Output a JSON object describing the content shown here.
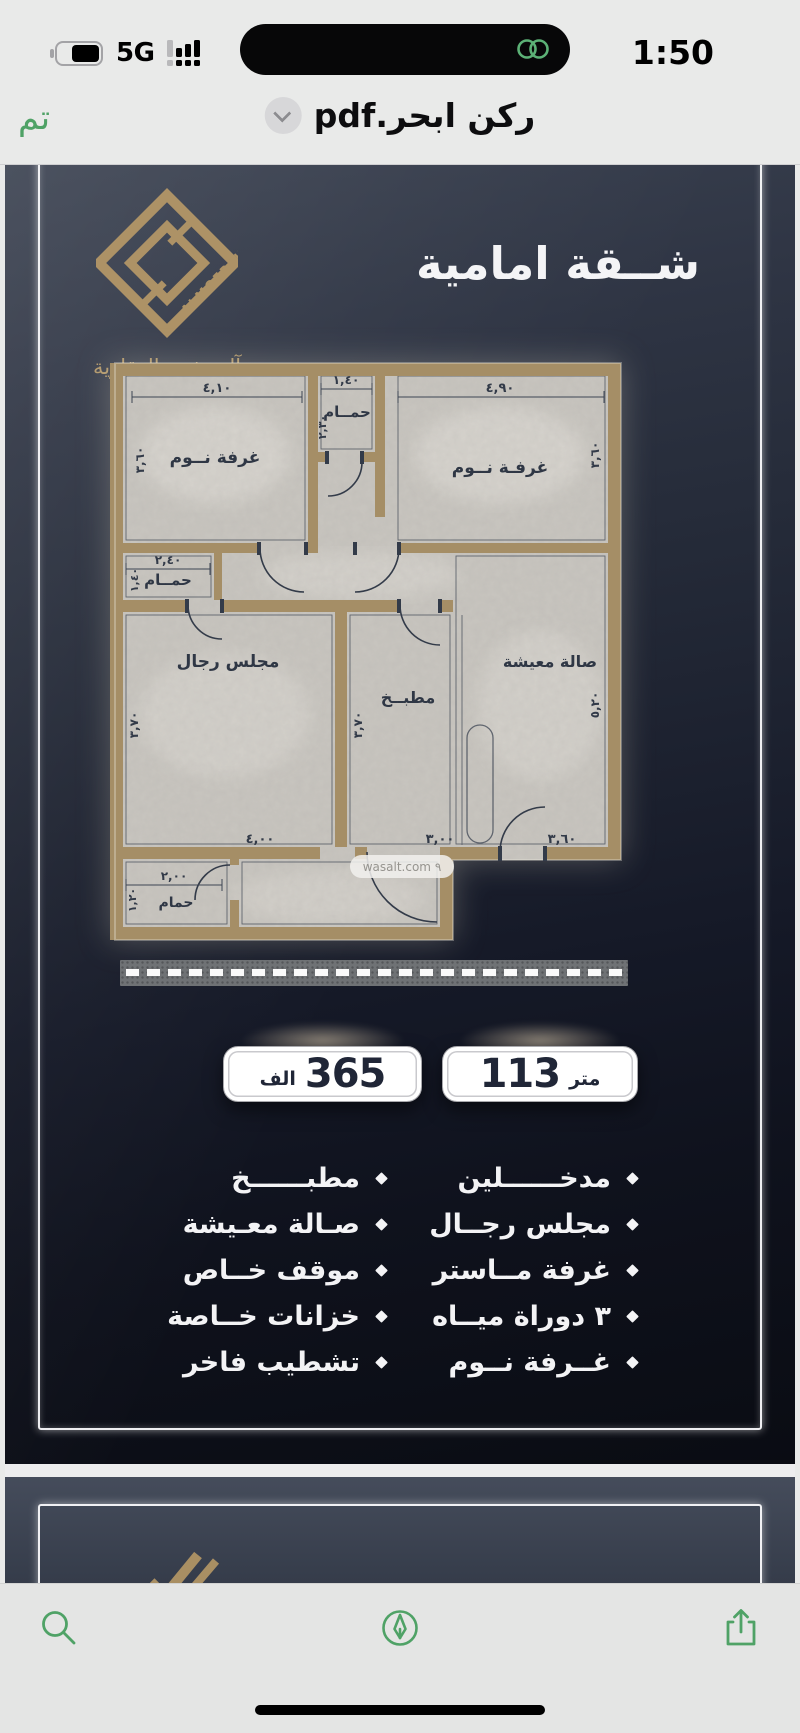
{
  "status_bar": {
    "time": "1:50",
    "network": "5G"
  },
  "nav_bar": {
    "done": "تم",
    "title": "ركن ابحر.pdf"
  },
  "page1": {
    "brand": {
      "wordmark": "ALMOFREH",
      "name": "آل مفرح العقارية"
    },
    "title": "شــقة امامية",
    "floor_plan": {
      "watermark": "wasalt.com ٩",
      "rooms": {
        "bedroom1": "غرفة نــوم",
        "bath1": "حمــام",
        "bedroom2": "غرفـة نــوم",
        "bath2": "حمــام",
        "majlis": "مجلس رجال",
        "kitchen": "مطبــخ",
        "living": "صالة معيشة",
        "bath3": "حمام"
      },
      "dims": {
        "bedroom1_w": "٤,١٠",
        "bedroom1_h": "٣,٦٠",
        "bath1_w": "١,٤٠",
        "bath1_h": "٢,٣٠",
        "bedroom2_w": "٤,٩٠",
        "bedroom2_h": "٣,٦٠",
        "bath2_w": "٢,٤٠",
        "bath2_h": "١,٤٠",
        "majlis_w": "٤,٠٠",
        "majlis_h": "٣,٧٠",
        "kitchen_w": "٣,٠٠",
        "kitchen_h": "٣,٧٠",
        "living_w": "٣,٦٠",
        "living_h": "٥,٢٠",
        "bath3_w": "٢,٠٠",
        "bath3_h": "١,٢٠"
      }
    },
    "badges": {
      "price": {
        "number": "365",
        "unit": "الف"
      },
      "area": {
        "number": "113",
        "unit": "متر"
      }
    },
    "features": {
      "right": [
        "مدخــــــلين",
        "مجلس رجــال",
        "غرفة مــاستر",
        "٣ دوراة ميــاه",
        "غــرفة نــوم"
      ],
      "left": [
        "مطبــــــخ",
        "صـالة معـيشة",
        "موقف خــاص",
        "خزانات خــاصة",
        "تشطيب فاخر"
      ]
    }
  },
  "colors": {
    "accent_green": "#4fa266",
    "gold": "#ab9166",
    "page_top": "#353c4b",
    "page_bottom": "#0b0d13",
    "badge_text": "#202637"
  }
}
